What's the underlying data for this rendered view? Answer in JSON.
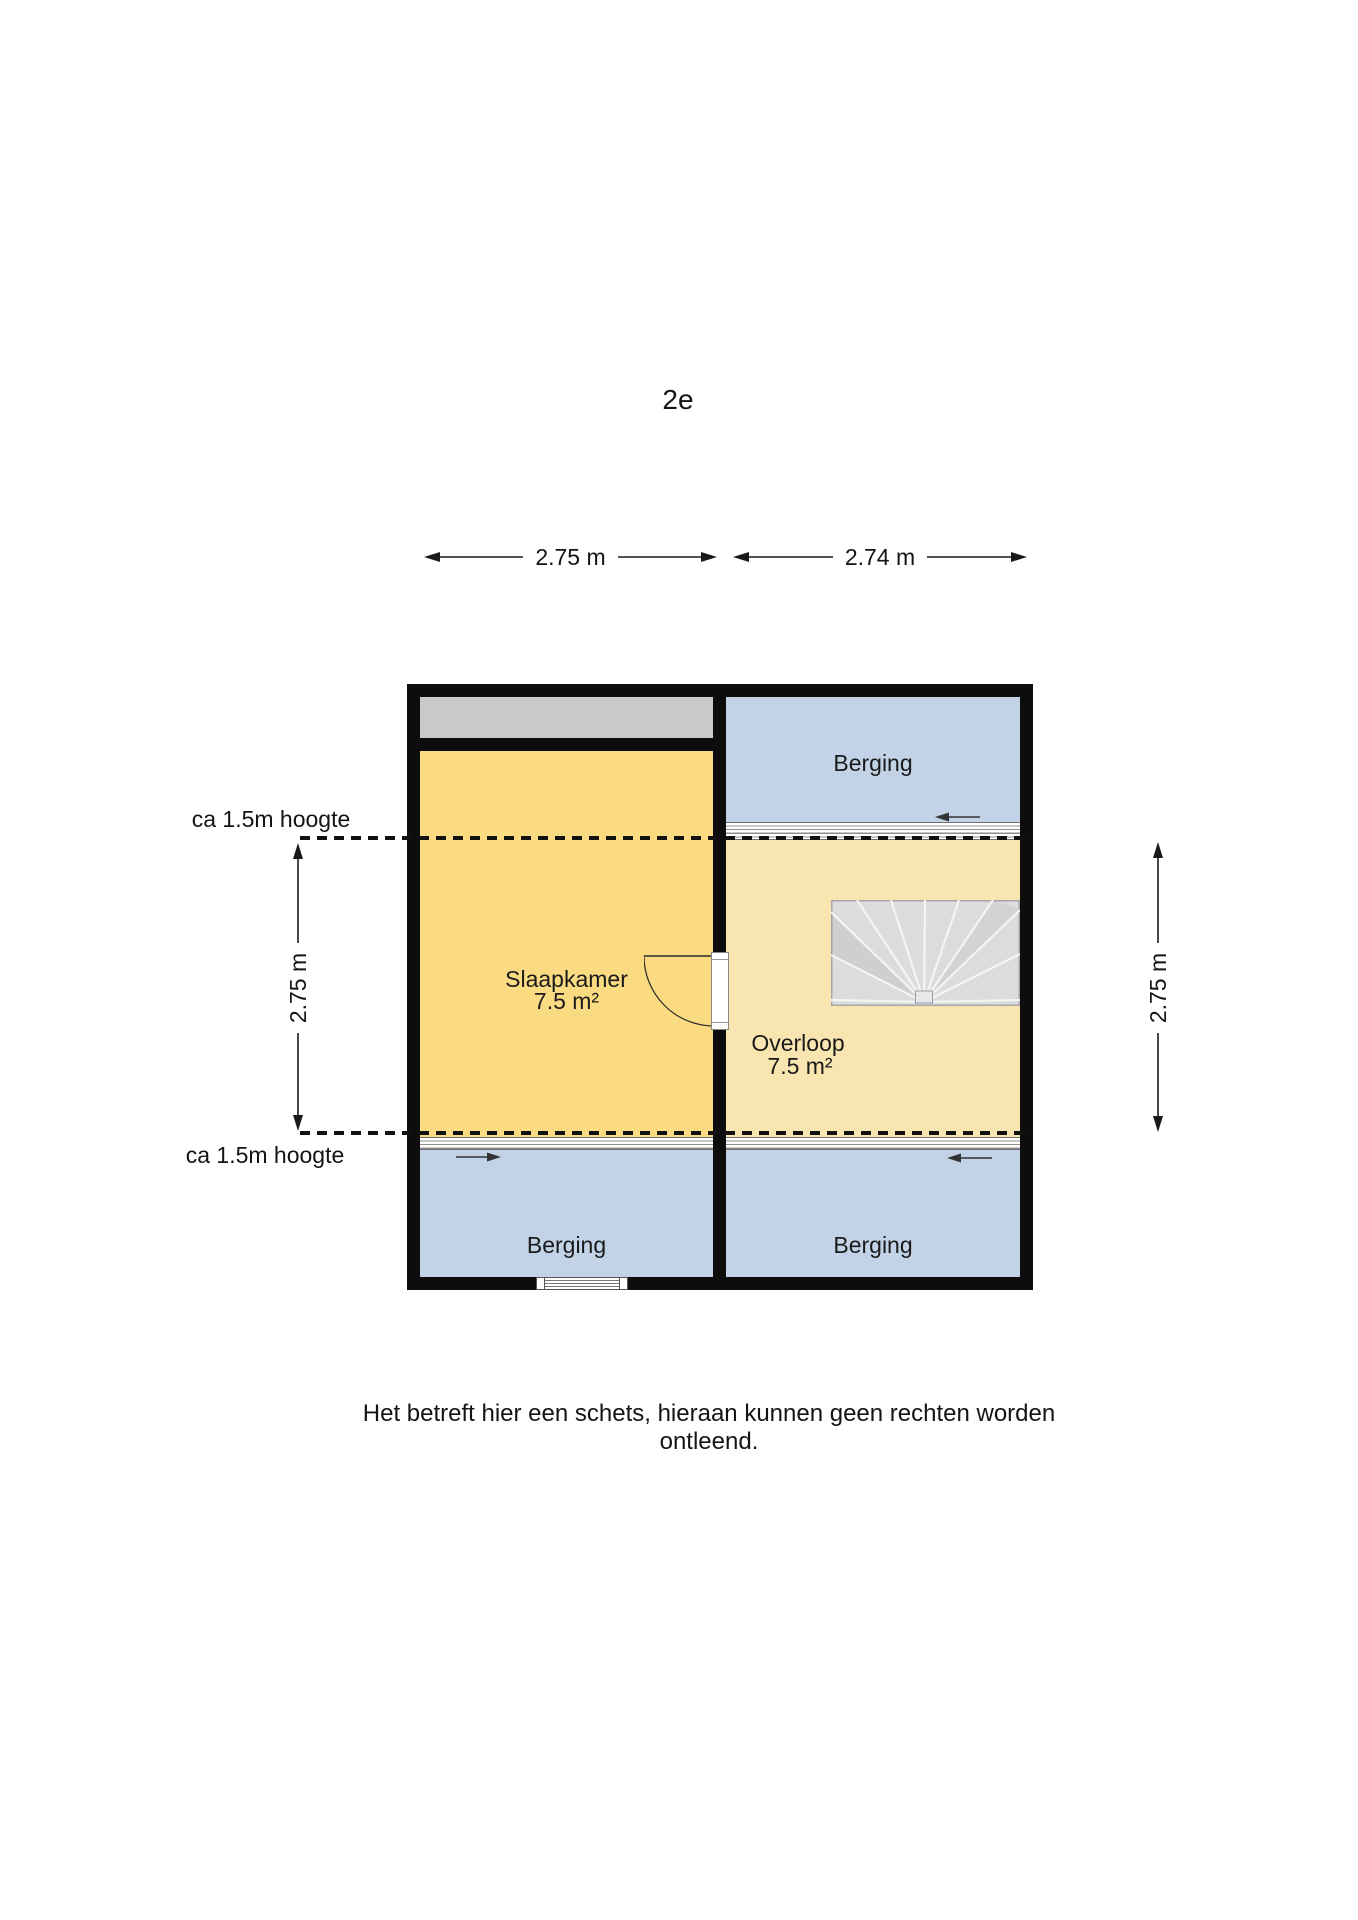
{
  "title": "2e",
  "dimension_labels": {
    "top_left": "2.75 m",
    "top_right": "2.74 m",
    "left": "2.75 m",
    "right": "2.75 m"
  },
  "height_notes": {
    "upper": "ca 1.5m hoogte",
    "lower": "ca 1.5m hoogte"
  },
  "floorplan": {
    "rooms": {
      "slaapkamer": {
        "name": "Slaapkamer",
        "area": "7.5 m²"
      },
      "overloop": {
        "name": "Overloop",
        "area": "7.5 m²"
      },
      "berging_top_right": {
        "name": "Berging"
      },
      "berging_bottom_left": {
        "name": "Berging"
      },
      "berging_bottom_right": {
        "name": "Berging"
      }
    },
    "features": {
      "stairs": "winder-stairs",
      "door": "door-swing-slaapkamer",
      "window": "window-bottom-wall",
      "attic_strip": "low-height-space"
    },
    "colors": {
      "wall": "#0d0d0d",
      "slaapkamer": "#fbdb82",
      "overloop": "#f9e5b0",
      "berging": "#c2d3e8",
      "low_space_gray": "#c9c9c9",
      "stairs": "#dcdcde"
    }
  },
  "disclaimer": "Het betreft hier een schets, hieraan kunnen geen rechten worden ontleend."
}
